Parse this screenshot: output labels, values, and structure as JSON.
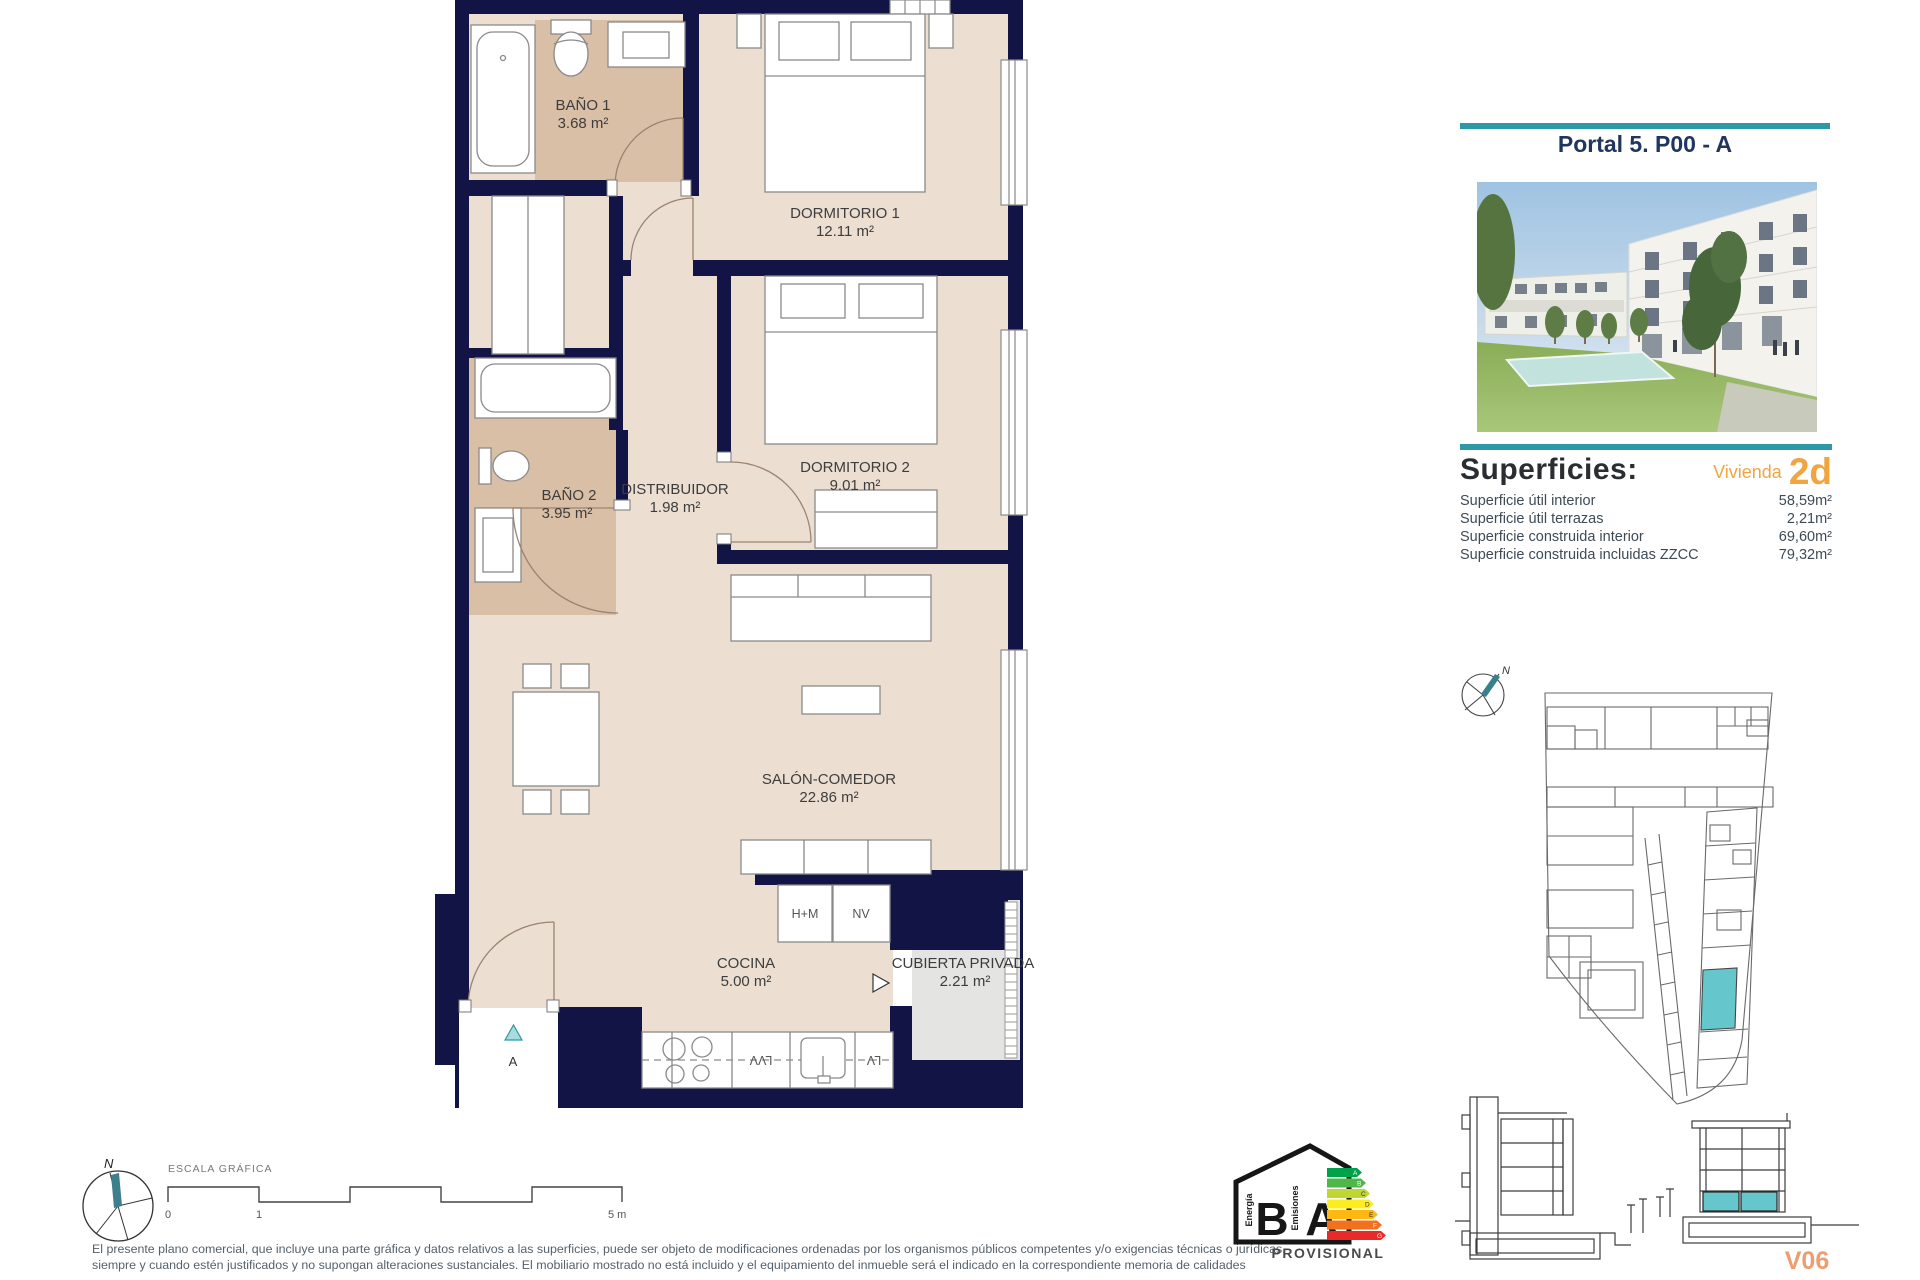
{
  "plan": {
    "rooms": [
      {
        "name": "BAÑO 1",
        "area": "3.68 m²"
      },
      {
        "name": "DORMITORIO 1",
        "area": "12.11 m²"
      },
      {
        "name": "DORMITORIO 2",
        "area": "9.01 m²"
      },
      {
        "name": "BAÑO 2",
        "area": "3.95 m²"
      },
      {
        "name": "DISTRIBUIDOR",
        "area": "1.98 m²"
      },
      {
        "name": "SALÓN-COMEDOR",
        "area": "22.86 m²"
      },
      {
        "name": "COCINA",
        "area": "5.00 m²"
      },
      {
        "name": "CUBIERTA PRIVADA",
        "area": "2.21 m²"
      }
    ],
    "appliances": {
      "hm": "H+M",
      "nv": "NV",
      "lvv": "LVV",
      "lv": "LV"
    },
    "entrance_label": "A"
  },
  "sidebar": {
    "title": "Portal 5. P00 - A",
    "superficies_heading": "Superficies:",
    "vivienda_label": "Vivienda",
    "vivienda_code": "2d",
    "surface_rows": [
      {
        "label": "Superficie útil interior",
        "value": "58,59m²"
      },
      {
        "label": "Superficie útil terrazas",
        "value": "2,21m²"
      },
      {
        "label": "Superficie construida interior",
        "value": "69,60m²"
      },
      {
        "label": "Superficie construida incluidas ZZCC",
        "value": "79,32m²"
      }
    ],
    "site_compass_label": "N",
    "version_label": "V06"
  },
  "footer": {
    "scale_label": "ESCALA GRÁFICA",
    "scale_ticks": [
      "0",
      "1",
      "5 m"
    ],
    "compass_label": "N",
    "disclaimer_line1": "El presente plano comercial, que incluye una parte gráfica y datos relativos a las superficies, puede ser objeto de modificaciones ordenadas por los organismos públicos competentes y/o exigencias técnicas o jurídicas,",
    "disclaimer_line2": "siempre y cuando estén justificados y no supongan alteraciones sustanciales. El mobiliario mostrado no está incluido y el equipamiento del inmueble será el indicado en la correspondiente memoria de calidades"
  },
  "energy_label": {
    "energy_text": "Energía",
    "emissions_text": "Emisiones",
    "letter_b": "B",
    "letter_a": "A",
    "status": "PROVISIONAL",
    "scale": [
      {
        "letter": "A",
        "color": "#00a14b"
      },
      {
        "letter": "B",
        "color": "#4db748"
      },
      {
        "letter": "C",
        "color": "#bfd730"
      },
      {
        "letter": "D",
        "color": "#fced21"
      },
      {
        "letter": "E",
        "color": "#fdb813"
      },
      {
        "letter": "F",
        "color": "#f3701e"
      },
      {
        "letter": "G",
        "color": "#e92a28"
      }
    ]
  },
  "colors": {
    "wall_navy": "#111445",
    "floor_beige": "#ecdfd2",
    "floor_tan": "#d9bfa5",
    "terrace_gray": "#e4e4e2",
    "accent_teal": "#2d98a6",
    "highlight_teal": "#65c6cc",
    "accent_orange": "#f0a541",
    "version_orange": "#ee9c72"
  }
}
